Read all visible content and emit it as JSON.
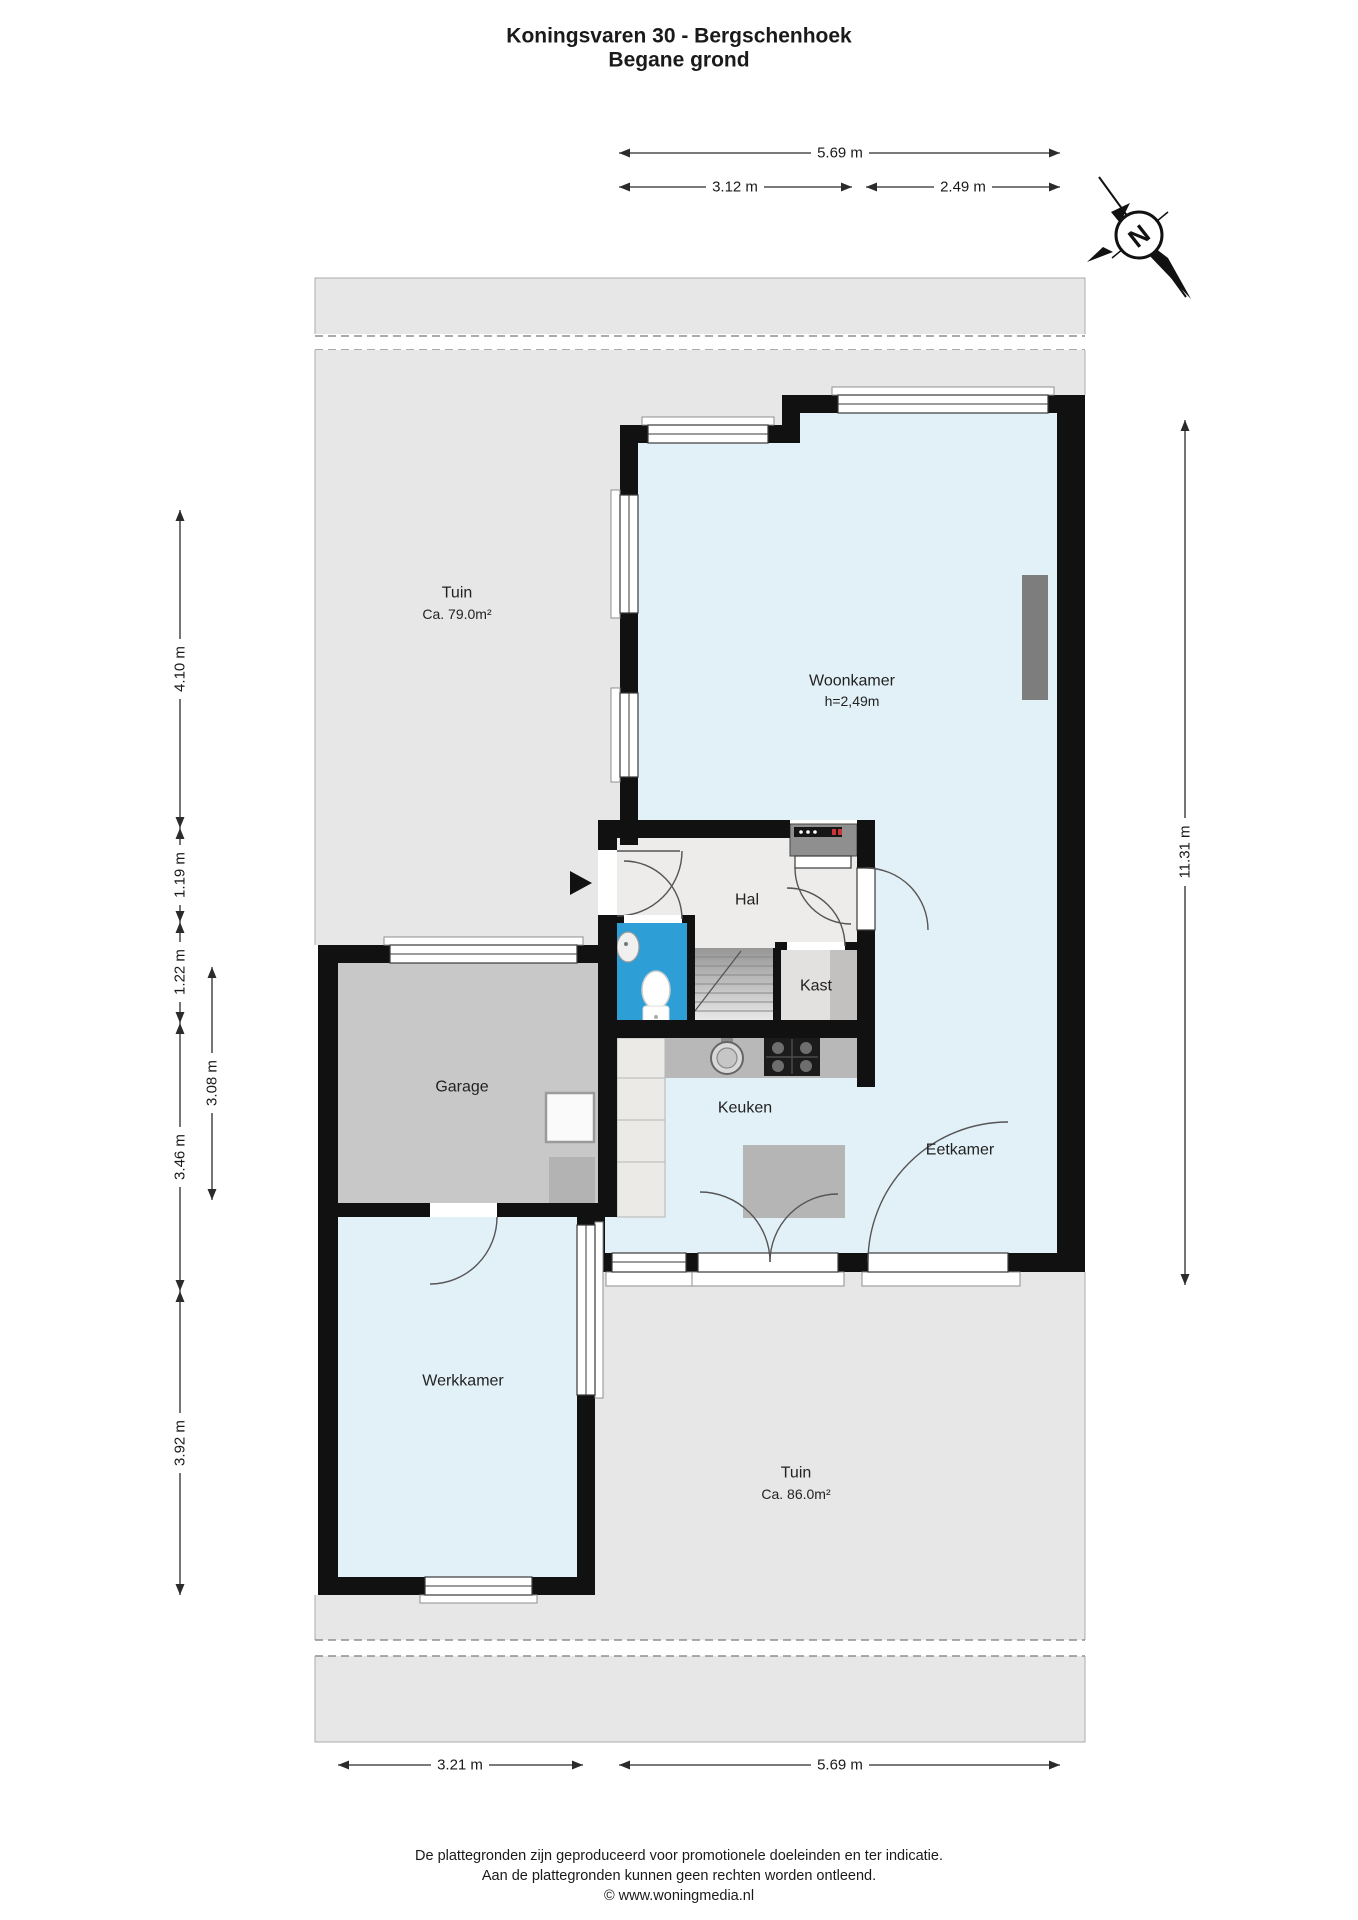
{
  "title": {
    "line1": "Koningsvaren 30 - Bergschenhoek",
    "line2": "Begane grond"
  },
  "compass": {
    "north_label": "N"
  },
  "rooms": {
    "tuin_boven": {
      "name": "Tuin",
      "area": "Ca. 79.0m²"
    },
    "woonkamer": {
      "name": "Woonkamer",
      "ceiling_height": "h=2,49m"
    },
    "hal": {
      "name": "Hal"
    },
    "kast": {
      "name": "Kast"
    },
    "garage": {
      "name": "Garage"
    },
    "keuken": {
      "name": "Keuken"
    },
    "eetkamer": {
      "name": "Eetkamer"
    },
    "werkkamer": {
      "name": "Werkkamer"
    },
    "tuin_onder": {
      "name": "Tuin",
      "area": "Ca. 86.0m²"
    }
  },
  "dimensions": {
    "top_total": "5.69 m",
    "top_left": "3.12 m",
    "top_right": "2.49 m",
    "left_a": "4.10 m",
    "left_b": "1.19 m",
    "left_c": "1.22 m",
    "left_d": "3.46 m",
    "left_e": "3.92 m",
    "left_inner": "3.08 m",
    "right_total": "11.31 m",
    "bottom_left": "3.21 m",
    "bottom_right": "5.69 m"
  },
  "footer": {
    "line1": "De plattegronden zijn geproduceerd voor promotionele doeleinden en ter indicatie.",
    "line2": "Aan de plattegronden kunnen geen rechten worden ontleend.",
    "line3": "© www.woningmedia.nl"
  },
  "colors": {
    "wall": "#111111",
    "living_floor": "#e2f1f8",
    "hal_floor": "#edecea",
    "garden": "#e7e7e7",
    "garage_floor": "#c8c8c8",
    "toilet_floor": "#2d9fd6",
    "counter": "#b8b8b8",
    "meter_panel": "#8f8f8f",
    "accent_red": "#cc3333"
  }
}
